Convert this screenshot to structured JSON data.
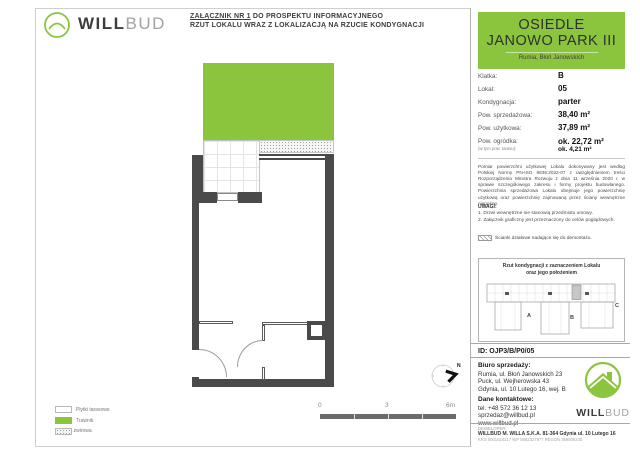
{
  "header": {
    "brand_will": "WILL",
    "brand_bud": "BUD",
    "attachment_line1_underlined": "ZAŁĄCZNIK NR 1",
    "attachment_line1_rest": " DO PROSPEKTU INFORMACYJNEGO",
    "attachment_line2": "RZUT LOKALU WRAZ Z LOKALIZACJĄ NA RZUCIE KONDYGNACJI"
  },
  "plan": {
    "legend": [
      {
        "label": "Płytki tarasowe"
      },
      {
        "label": "Trawnik"
      },
      {
        "label": "Opaska żwirowa"
      }
    ],
    "scale": {
      "tick0": "0",
      "tick1": "3",
      "tick2": "6m"
    },
    "compass_label": "N"
  },
  "panel": {
    "estate": {
      "title_line1": "OSIEDLE",
      "title_line2": "JANOWO PARK III",
      "subtitle": "Rumia, Błoń Janowskich"
    },
    "details": [
      {
        "label": "Klatka:",
        "value": "B"
      },
      {
        "label": "Lokal:",
        "value": "05"
      },
      {
        "label": "Kondygnacja:",
        "value": "parter"
      },
      {
        "label": "Pow. sprzedażowa:",
        "value": "38,40 m²"
      },
      {
        "label": "Pow. użytkowa:",
        "value": "37,89 m²"
      },
      {
        "label": "Pow. ogródka:",
        "sublabel": "(w tym pow. tarasu):",
        "value": "ok. 22,72 m²",
        "subvalue": "ok. 4,21 m²"
      }
    ],
    "disclaimer": "Pomiar powierzchni użytkowej Lokalu dokonywany jest według Polskiej Normy PN-ISO 9836:2022-07 z uwzględnieniem treści Rozporządzenia Ministra Rozwoju z dnia 11 września 2020 r. w sprawie szczegółowego zakresu i formy projektu budowlanego. Powierzchnia sprzedażowa Lokalu obejmuje jego powierzchnię użytkową oraz powierzchnię zajmowaną przez ściany wewnętrzne nienośne.",
    "uwagi_title": "UWAGI:",
    "uwagi_items": [
      "1. Drzwi wewnętrzne nie stanowią przedmiotu umowy.",
      "2. Załącznik graficzny jest przeznaczony do celów poglądowych."
    ],
    "hatch_note": "Ścianki działowe nadające się do demontażu.",
    "mini_plan": {
      "title_line1": "Rzut kondygnacji z zaznaczeniem Lokalu",
      "title_line2": "oraz jego położeniem",
      "labels": [
        "A",
        "B",
        "C"
      ]
    },
    "unit_id": "ID: OJP3/B/P0/05",
    "sales": {
      "title": "Biuro sprzedaży:",
      "addresses": [
        "Rumia, ul. Błoń Janowskich 23",
        "Puck, ul. Wejherowska 43",
        "Gdynia, ul. 10 Lutego 16, wej. B"
      ],
      "contact_title": "Dane kontaktowe:",
      "contact_lines": [
        "tel. +48 572 36 12 13",
        "sprzedaz@willbud.pl",
        "www.willbud.pl"
      ]
    },
    "developer": {
      "label": "DEWELOPER:",
      "name": "WILLBUD M. WILLA S.K.A. 81-364 Gdynia ul. 10 Lutego 16",
      "ids": "KRS 0001024217 NIP 5862327977 REGON 369506340"
    }
  },
  "colors": {
    "green": "#8bc53e",
    "wall": "#4a4a4a",
    "unit_highlight": "#c6c6c6"
  }
}
